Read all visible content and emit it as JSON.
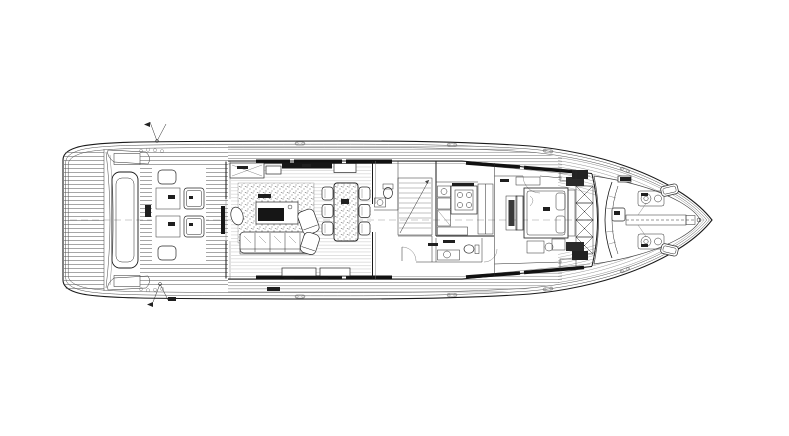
{
  "canvas": {
    "width": 789,
    "height": 436,
    "background": "#ffffff",
    "ink": "#1a1a1a"
  },
  "diagram": {
    "type": "floor-plan",
    "title": "Motor yacht main deck arrangement drawing, bow to the right",
    "orientation": "bow-right",
    "legible_text": "none (all annotations are sub-legible fine print)",
    "areas": [
      {
        "id": "swim-platform",
        "label": "aft swim platform with teak planking"
      },
      {
        "id": "tender-garage",
        "label": "transom garage hatch"
      },
      {
        "id": "transom-stairs",
        "label": "port and starboard transom stairs"
      },
      {
        "id": "aft-cockpit",
        "label": "aft deck with twin benches, tables and stools"
      },
      {
        "id": "salon",
        "label": "salon with sofa, coffee table, armchairs and carpet"
      },
      {
        "id": "dining-area",
        "label": "dining table with six chairs"
      },
      {
        "id": "staircase",
        "label": "central staircase and day head"
      },
      {
        "id": "galley",
        "label": "galley with cooktop and counters"
      },
      {
        "id": "owner-stateroom",
        "label": "forward owner stateroom with double bed"
      },
      {
        "id": "windshield",
        "label": "raked windshield mullions"
      },
      {
        "id": "foredeck",
        "label": "foredeck with curved settee and table"
      },
      {
        "id": "ground-tackle",
        "label": "anchor windlasses and chain track"
      },
      {
        "id": "bow",
        "label": "bow stem fitting"
      }
    ],
    "micro_labels": [
      {
        "x": 145,
        "y": 205,
        "w": 6,
        "h": 12
      },
      {
        "x": 168,
        "y": 195,
        "w": 7,
        "h": 4
      },
      {
        "x": 168,
        "y": 222,
        "w": 7,
        "h": 4
      },
      {
        "x": 189,
        "y": 196,
        "w": 4,
        "h": 3
      },
      {
        "x": 189,
        "y": 223,
        "w": 4,
        "h": 3
      },
      {
        "x": 258,
        "y": 194,
        "w": 13,
        "h": 4
      },
      {
        "x": 341,
        "y": 199,
        "w": 8,
        "h": 5
      },
      {
        "x": 237,
        "y": 166,
        "w": 11,
        "h": 3
      },
      {
        "x": 302,
        "y": 164,
        "w": 9,
        "h": 3
      },
      {
        "x": 452,
        "y": 183,
        "w": 22,
        "h": 3
      },
      {
        "x": 443,
        "y": 240,
        "w": 12,
        "h": 3
      },
      {
        "x": 428,
        "y": 243,
        "w": 10,
        "h": 3
      },
      {
        "x": 543,
        "y": 207,
        "w": 7,
        "h": 4
      },
      {
        "x": 500,
        "y": 179,
        "w": 9,
        "h": 3
      },
      {
        "x": 620,
        "y": 177,
        "w": 11,
        "h": 4
      },
      {
        "x": 641,
        "y": 193,
        "w": 7,
        "h": 3
      },
      {
        "x": 641,
        "y": 244,
        "w": 7,
        "h": 3
      },
      {
        "x": 267,
        "y": 287,
        "w": 13,
        "h": 4
      },
      {
        "x": 168,
        "y": 297,
        "w": 8,
        "h": 4
      },
      {
        "x": 614,
        "y": 211,
        "w": 6,
        "h": 4
      }
    ],
    "colors": {
      "plank": "#606060",
      "light_plank": "#9a9a9a",
      "window_glass": "#111111",
      "label_ink": "#1f1f1f"
    }
  }
}
